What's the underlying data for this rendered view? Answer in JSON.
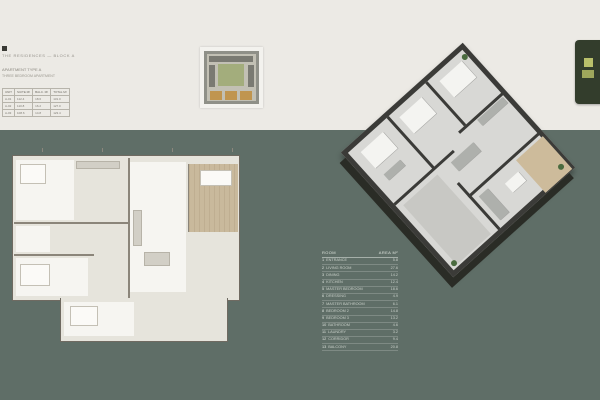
{
  "page": {
    "bg_top": "#ECEAE5",
    "bg_bottom": "#5F6E67",
    "accent_wood": "#C9B99C",
    "badge_bg": "#333D2C",
    "keyplan_highlight": "#C0954F"
  },
  "header": {
    "line1": "THE RESIDENCES — BLOCK A",
    "line2": "APARTMENT TYPE A",
    "line3": "THREE BEDROOM APARTMENT",
    "info_table": {
      "headers": [
        "UNIT",
        "SUITE M²",
        "BALC. M²",
        "TOTAL M²"
      ],
      "rows": [
        [
          "A-01",
          "112.4",
          "18.6",
          "131.0"
        ],
        [
          "A-02",
          "110.8",
          "16.2",
          "127.0"
        ],
        [
          "A-03",
          "108.6",
          "14.8",
          "123.4"
        ]
      ]
    }
  },
  "legend": {
    "name_col": "ROOM",
    "area_col": "AREA M²",
    "rows": [
      {
        "no": "1",
        "name": "ENTRANCE",
        "area": "5.8"
      },
      {
        "no": "2",
        "name": "LIVING ROOM",
        "area": "27.6"
      },
      {
        "no": "3",
        "name": "DINING",
        "area": "14.2"
      },
      {
        "no": "4",
        "name": "KITCHEN",
        "area": "12.4"
      },
      {
        "no": "5",
        "name": "MASTER BEDROOM",
        "area": "18.6"
      },
      {
        "no": "6",
        "name": "DRESSING",
        "area": "4.9"
      },
      {
        "no": "7",
        "name": "MASTER BATHROOM",
        "area": "6.1"
      },
      {
        "no": "8",
        "name": "BEDROOM 2",
        "area": "14.8"
      },
      {
        "no": "9",
        "name": "BEDROOM 3",
        "area": "13.2"
      },
      {
        "no": "10",
        "name": "BATHROOM",
        "area": "4.6"
      },
      {
        "no": "11",
        "name": "LAUNDRY",
        "area": "3.2"
      },
      {
        "no": "12",
        "name": "CORRIDOR",
        "area": "9.4"
      },
      {
        "no": "13",
        "name": "BALCONY",
        "area": "20.8"
      }
    ]
  }
}
